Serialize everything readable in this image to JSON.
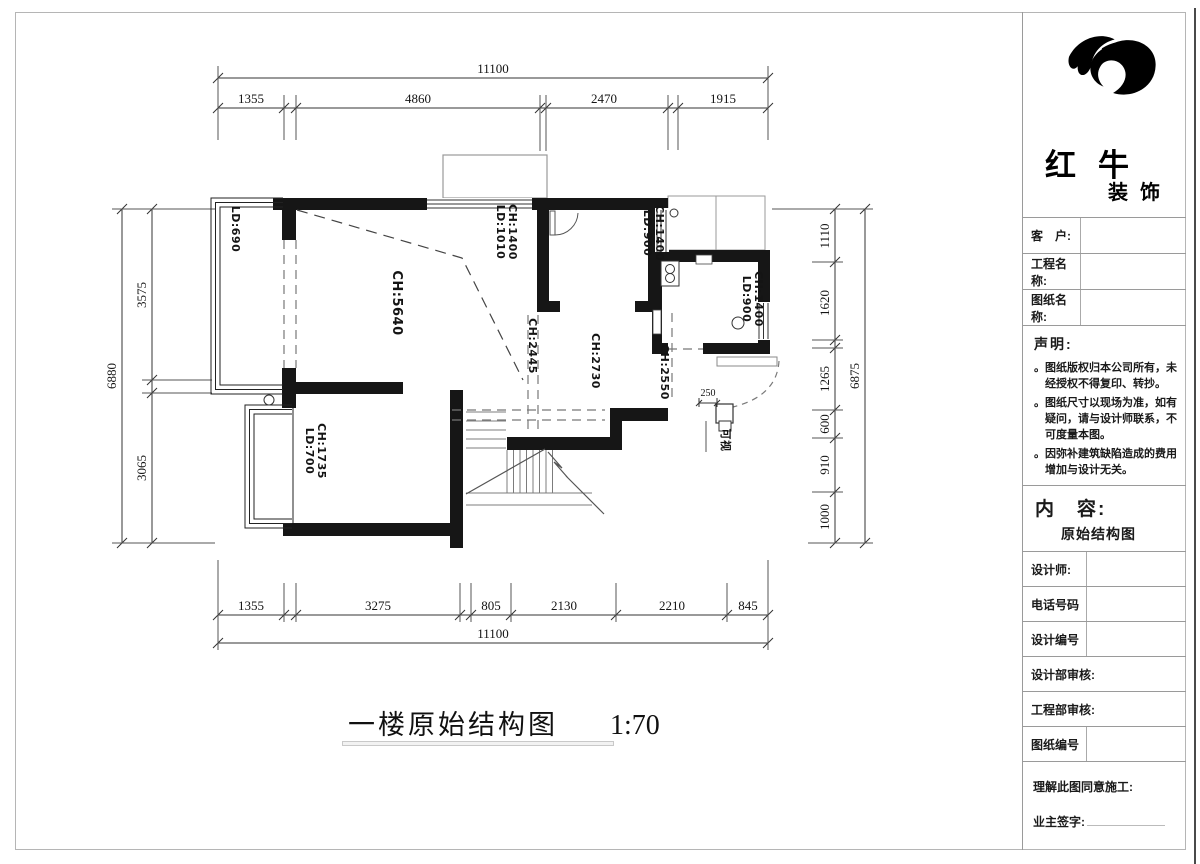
{
  "plan": {
    "dims": {
      "top": {
        "total": "11100",
        "segments": [
          "1355",
          "4860",
          "2470",
          "1915"
        ]
      },
      "bottom": {
        "total": "11100",
        "segments": [
          "1355",
          "3275",
          "805",
          "2130",
          "2210",
          "845"
        ]
      },
      "left": {
        "total": "6880",
        "segments": [
          "3575",
          "3065"
        ]
      },
      "right": {
        "total": "6875",
        "segments": [
          "1110",
          "1620",
          "1265",
          "600",
          "910",
          "1000"
        ]
      }
    },
    "labels": {
      "balcony_window": "LD:690",
      "living": "CH:5640",
      "top_window": [
        "LD:1010",
        "CH:1400"
      ],
      "kitchen_window_left": [
        "LD:900",
        "CH:1400"
      ],
      "kitchen_window_right": [
        "LD:900",
        "CH:1400"
      ],
      "hall": "CH:2445",
      "bedroom": "CH:2730",
      "entry": "CH:2550",
      "lower_window": [
        "LD:700",
        "CH:1735"
      ],
      "door_offset": "250",
      "intercom": "可视"
    }
  },
  "caption": {
    "title": "一楼原始结构图",
    "scale": "1:70"
  },
  "titleblock": {
    "brand": {
      "name": "红牛",
      "sub": "装饰"
    },
    "rows": {
      "customer": "客　户:",
      "project": "工程名称:",
      "drawing": "图纸名称:",
      "designer": "设计师:",
      "phone": "电话号码",
      "design_no": "设计编号",
      "design_review": "设计部审核:",
      "eng_review": "工程部审核:",
      "drawing_no": "图纸编号"
    },
    "statement": {
      "heading": "声明:",
      "items": [
        "。图纸版权归本公司所有，未经授权不得复印、转抄。",
        "。图纸尺寸以现场为准，如有疑问，请与设计师联系，不可度量本图。",
        "。因弥补建筑缺陷造成的费用增加与设计无关。"
      ]
    },
    "content": {
      "label": "内　容:",
      "value": "原始结构图"
    },
    "footer": {
      "note": "理解此图同意施工:",
      "sign": "业主签字:"
    }
  }
}
